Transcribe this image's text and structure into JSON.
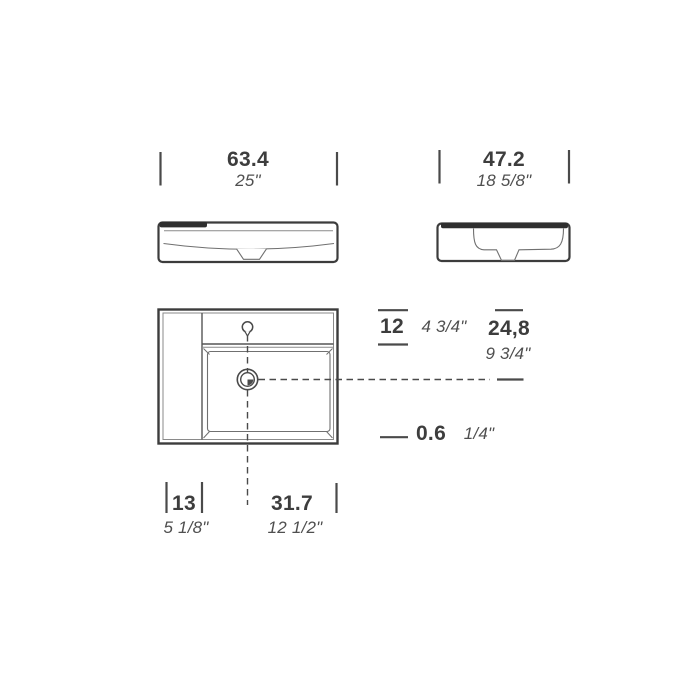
{
  "drawing": {
    "subject": "washbasin technical drawing (front view, side view, plan view)",
    "colors": {
      "background": "#ffffff",
      "heavy_line": "#3c3c3c",
      "light_line": "#707070",
      "solid_fill_bar": "#2f2f2f",
      "metric_text": "#3d3d3d",
      "imperial_text": "#4f4f4f"
    },
    "dims": {
      "width": {
        "cm": "63.4",
        "in": "25\""
      },
      "depth": {
        "cm": "47.2",
        "in": "18 5/8\""
      },
      "deck": {
        "cm": "12",
        "in": "4 3/4\""
      },
      "drain_back": {
        "cm": "24,8",
        "in": "9 3/4\""
      },
      "rim": {
        "cm": "0.6",
        "in": "1/4\""
      },
      "shelf": {
        "cm": "13",
        "in": "5 1/8\""
      },
      "drain_side": {
        "cm": "31.7",
        "in": "12 1/2\""
      }
    }
  }
}
